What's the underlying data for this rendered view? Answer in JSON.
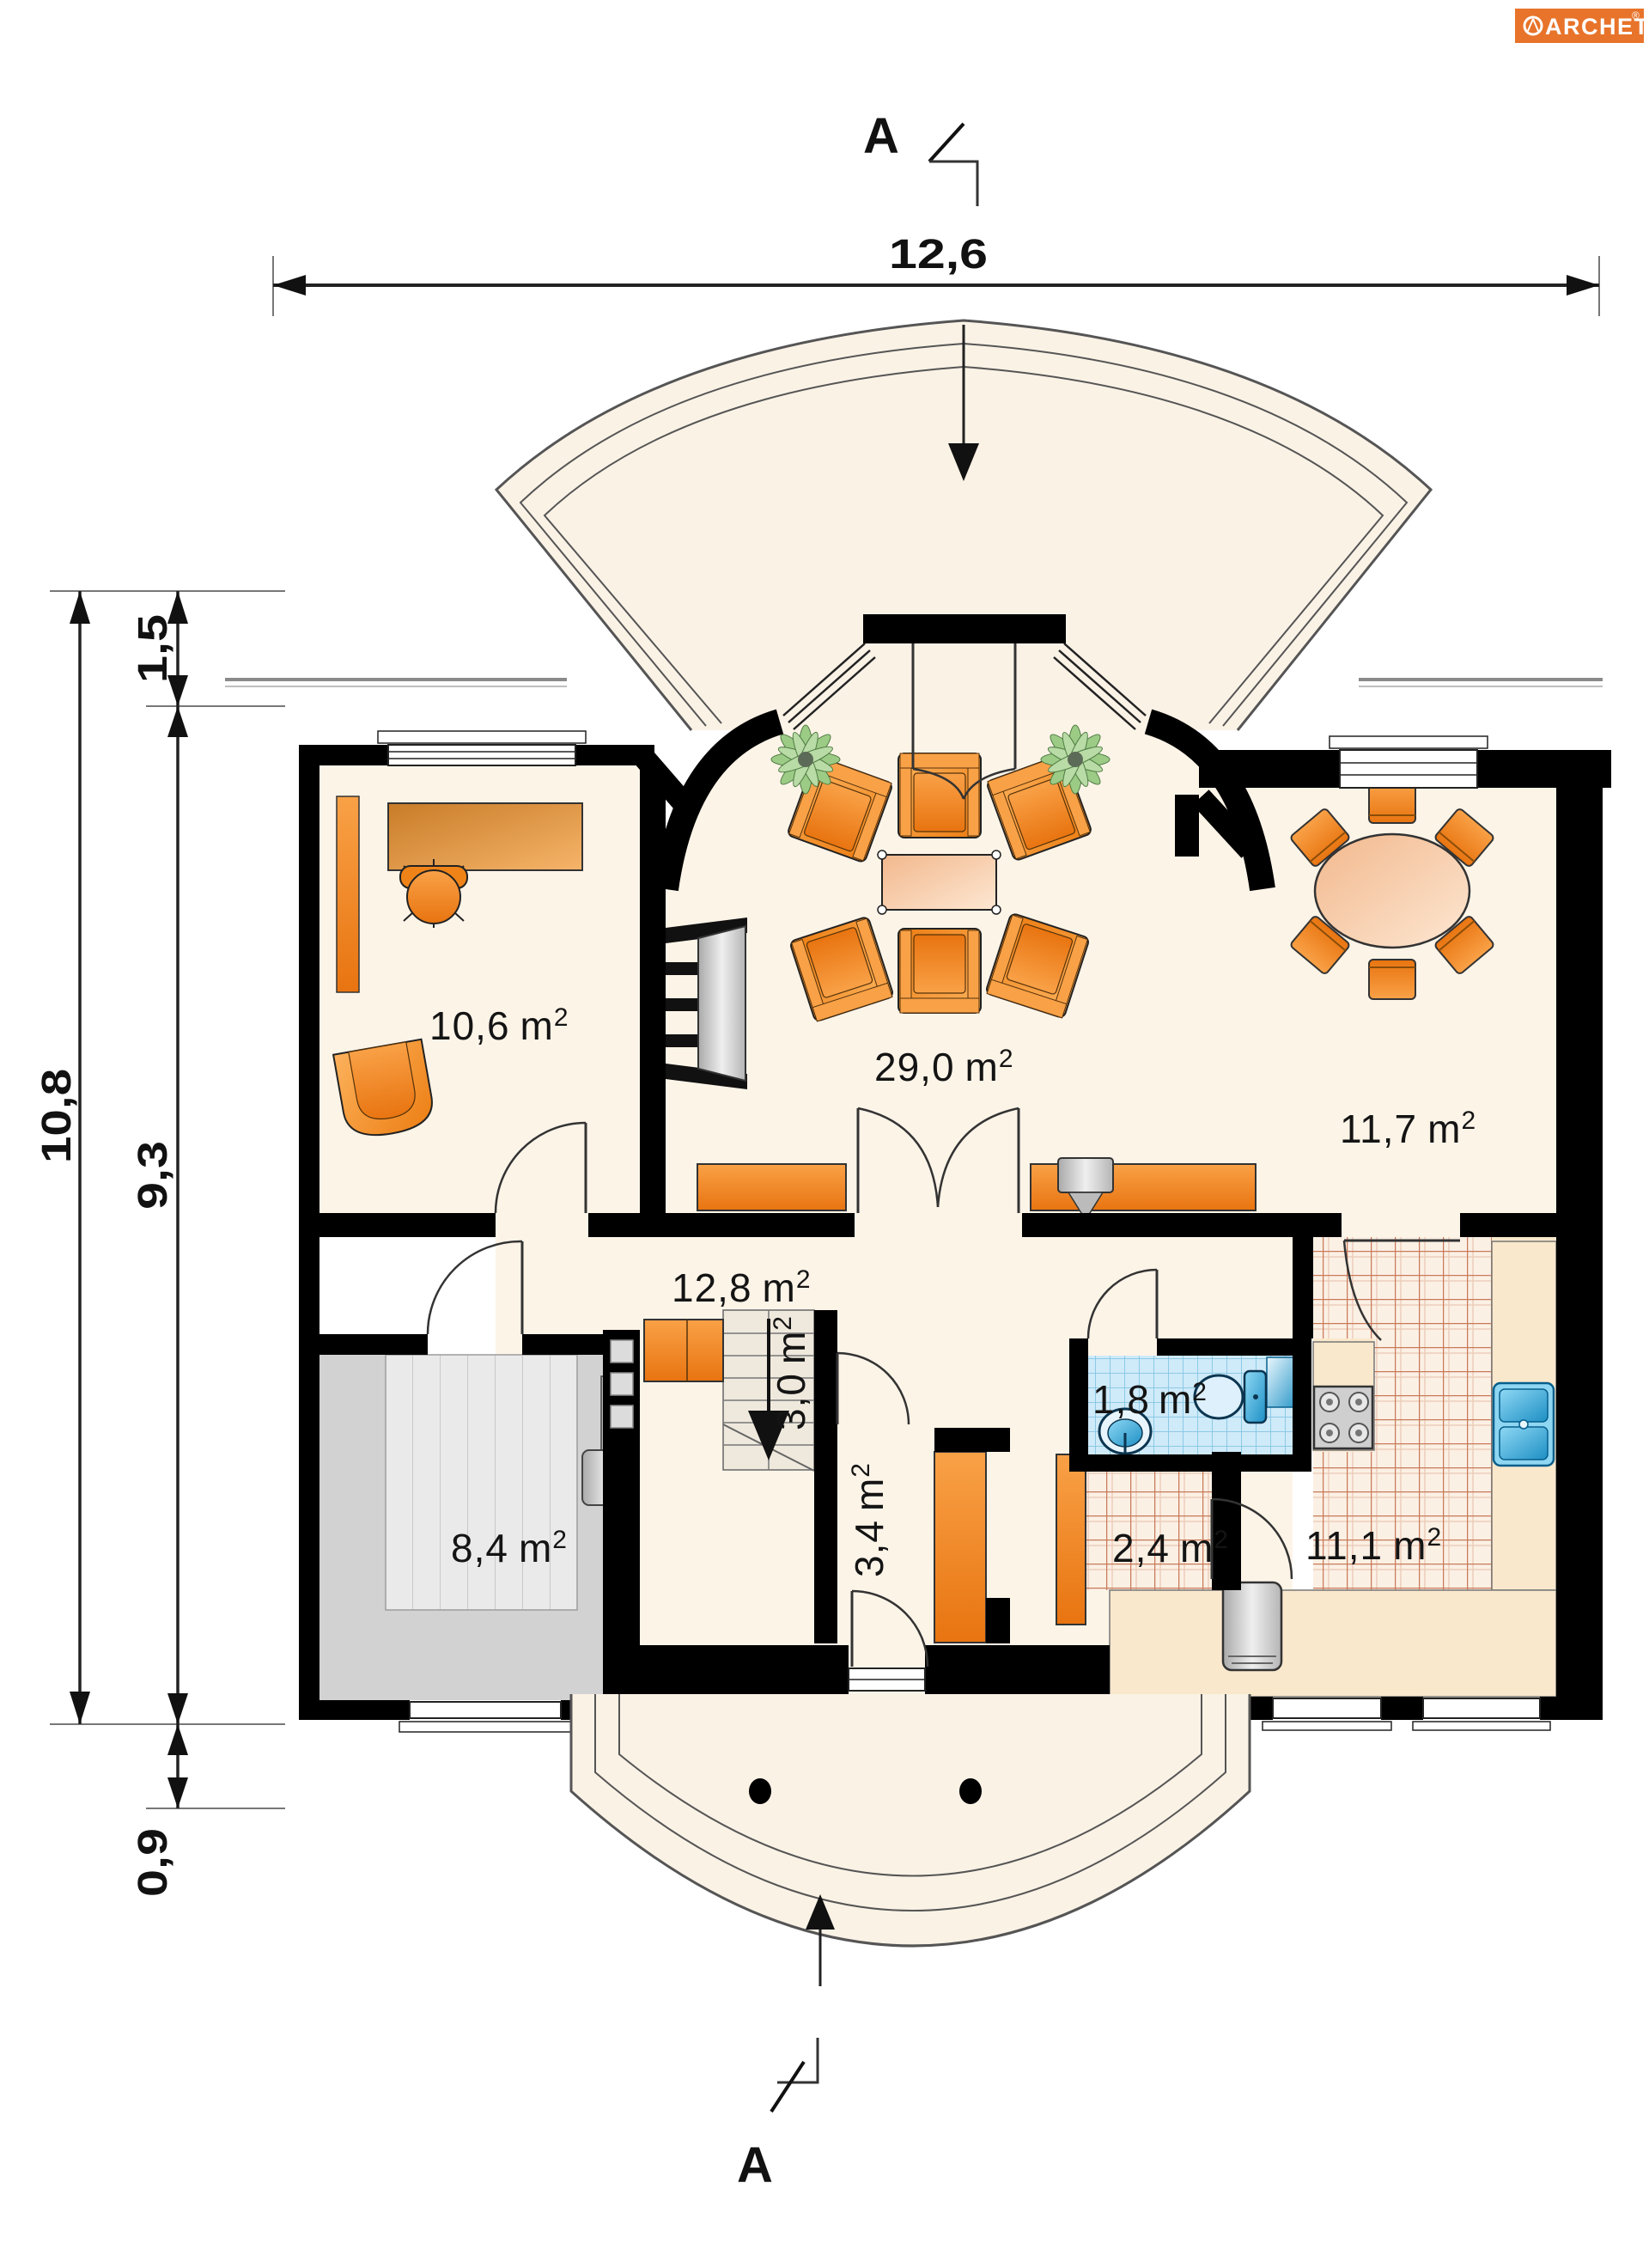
{
  "logo": {
    "brand": "ARCHETON",
    "registered": "®"
  },
  "section_markers": {
    "top": "A",
    "bottom": "A"
  },
  "dimensions": {
    "overall_width": "12,6",
    "total_depth": "10,8",
    "front_terrace_depth": "1,5",
    "house_depth": "9,3",
    "rear_terrace_depth": "0,9"
  },
  "rooms": [
    {
      "id": "office",
      "area": "10,6",
      "unit": "m",
      "sup": "2"
    },
    {
      "id": "living-room",
      "area": "29,0",
      "unit": "m",
      "sup": "2"
    },
    {
      "id": "dining-room",
      "area": "11,7",
      "unit": "m",
      "sup": "2"
    },
    {
      "id": "hall",
      "area": "12,8",
      "unit": "m",
      "sup": "2"
    },
    {
      "id": "stairs",
      "area": "3,0",
      "unit": "m",
      "sup": "2"
    },
    {
      "id": "corridor",
      "area": "3,4",
      "unit": "m",
      "sup": "2"
    },
    {
      "id": "wc",
      "area": "1,8",
      "unit": "m",
      "sup": "2"
    },
    {
      "id": "pantry",
      "area": "2,4",
      "unit": "m",
      "sup": "2"
    },
    {
      "id": "kitchen",
      "area": "11,1",
      "unit": "m",
      "sup": "2"
    },
    {
      "id": "boiler-room",
      "area": "8,4",
      "unit": "m",
      "sup": "2"
    }
  ],
  "colors": {
    "wall": "#000000",
    "floor_cream": "#fdf4e8",
    "terrace_cream": "#fbf2e6",
    "furniture_orange": "#f28a1e",
    "tile_line": "#c97a5a",
    "wet_room_blue": "#cfeaf8",
    "fixture_blue": "#2aa7dc",
    "garage_gray": "#d2d2d2",
    "logo_orange": "#e8732a"
  }
}
